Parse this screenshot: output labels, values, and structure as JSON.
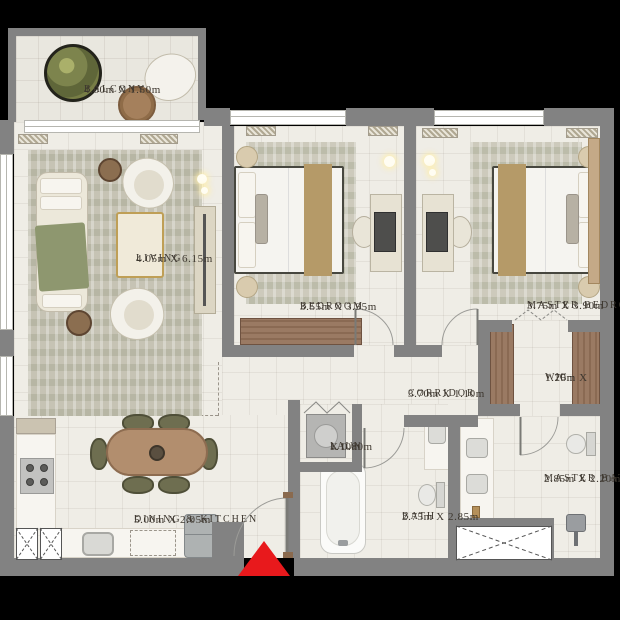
{
  "rooms": {
    "balcony": {
      "name": "BALCONY",
      "dims": "4.00m X 1.50m"
    },
    "living": {
      "name": "LIVING",
      "dims": "4.05m X 6.15m"
    },
    "bedroom": {
      "name": "BEDROOM",
      "dims": "3.55m X 3.95m"
    },
    "master_bedroom": {
      "name": "MASTER BEDROOM",
      "dims": "3.75m X 3.90m"
    },
    "corridor": {
      "name": "CORRIDOR",
      "dims": "3.70m X 1.10m"
    },
    "wic": {
      "name": "WIC",
      "dims_line1": "1.20m X",
      "dims_line2": "1.75m"
    },
    "laundry": {
      "name": "LAUN",
      "dims_line1": "1.10m",
      "dims_line2": "X 0.80m"
    },
    "bath": {
      "name": "BATH",
      "dims": "2.75m X 2.85m"
    },
    "master_bath": {
      "name": "MASTER BATH",
      "dims": "2.85m X 2.20m"
    },
    "dining_kitchen": {
      "name": "DINING & KITCHEN",
      "dims": "5.00m X 2.05m"
    }
  },
  "colors": {
    "background": "#000000",
    "wall": "#828282",
    "floor": "#efede6",
    "rug": "#c6c3b4",
    "wood": "#9a7a63",
    "olive_chair": "#6e6e50",
    "entrance_accent": "#e8191c",
    "label_text": "#3d372f"
  },
  "icons": {
    "entrance_marker": "red-up-triangle",
    "shaft": "dashed-x-duct-box",
    "bifold_door": "zigzag-panels",
    "plant": "round-planter"
  }
}
